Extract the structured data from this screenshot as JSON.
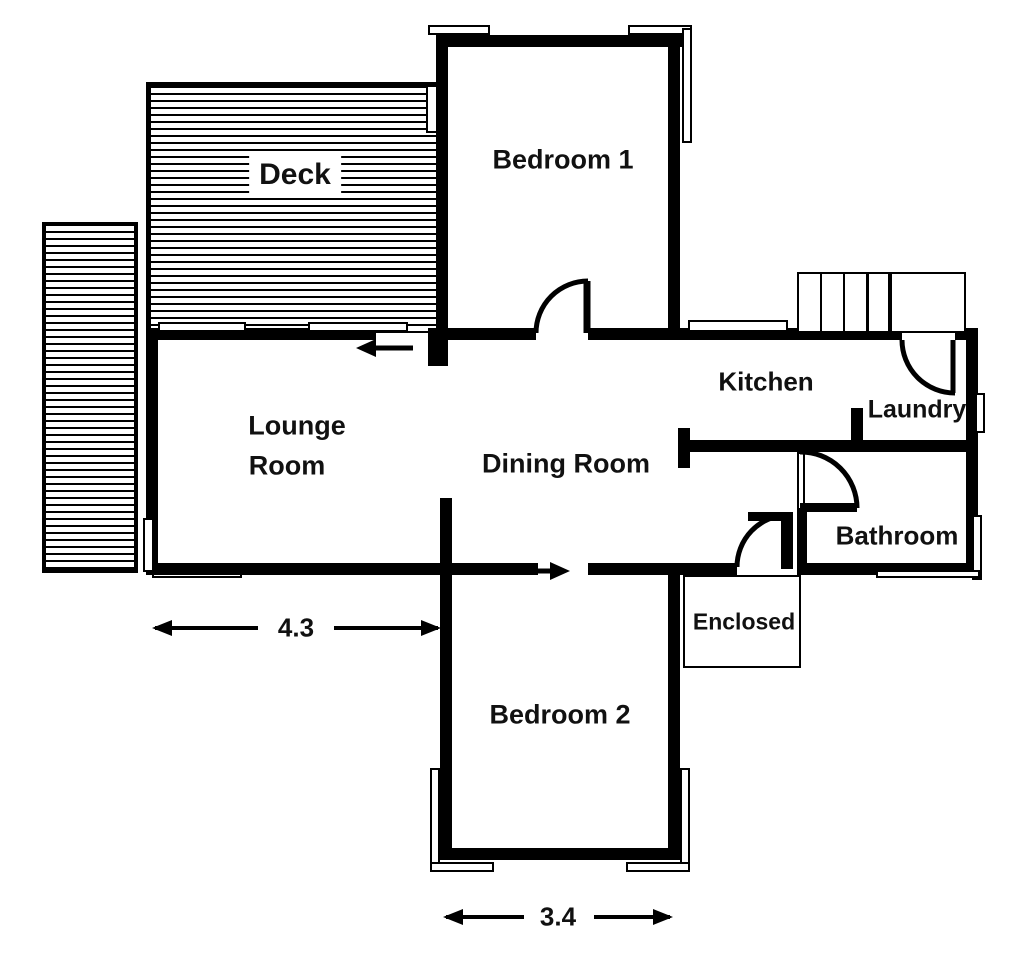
{
  "rooms": {
    "deck": {
      "label": "Deck"
    },
    "bedroom1": {
      "label": "Bedroom 1"
    },
    "kitchen": {
      "label": "Kitchen"
    },
    "laundry": {
      "label": "Laundry"
    },
    "lounge": {
      "label_line1": "Lounge",
      "label_line2": "Room"
    },
    "dining": {
      "label": "Dining Room"
    },
    "bathroom": {
      "label": "Bathroom"
    },
    "enclosed": {
      "label": "Enclosed"
    },
    "bedroom2": {
      "label": "Bedroom 2"
    }
  },
  "dimensions": {
    "lounge_width": {
      "value": "4.3"
    },
    "bedroom2_width": {
      "value": "3.4"
    }
  },
  "colors": {
    "wall": "#000000",
    "background": "#ffffff",
    "text": "#111111"
  }
}
